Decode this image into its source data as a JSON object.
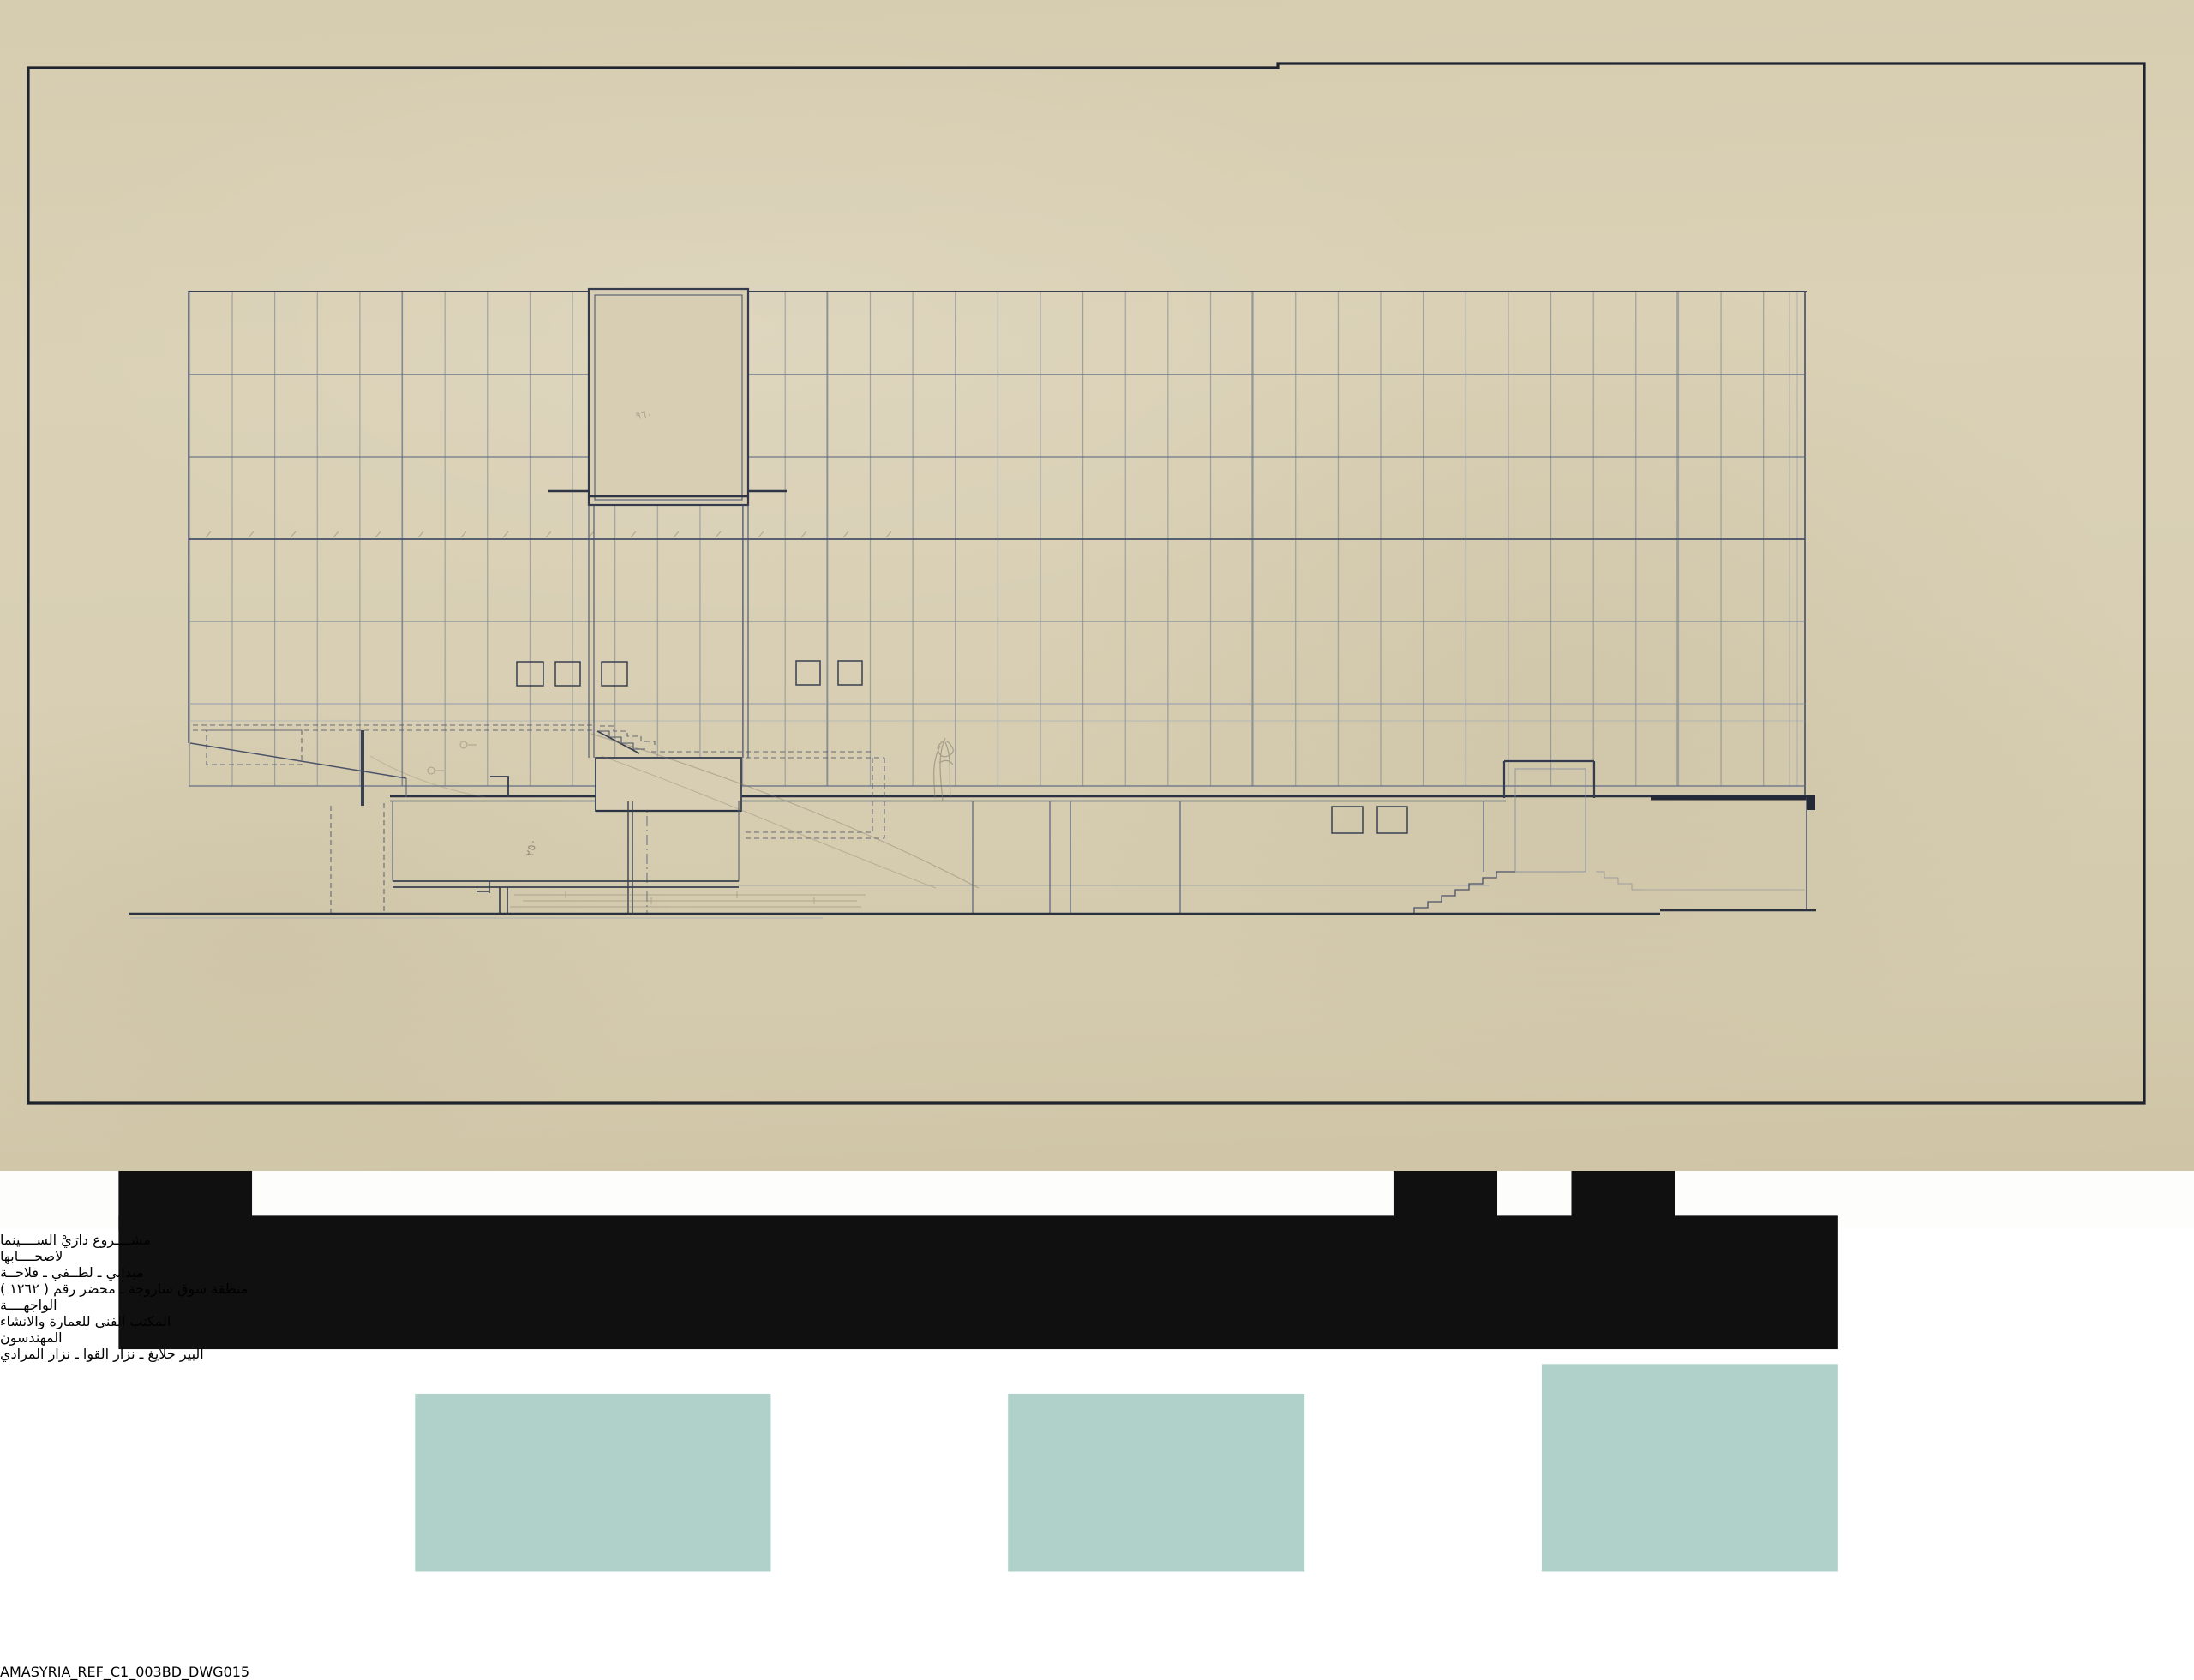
{
  "document": {
    "kind": "scanned architectural elevation drawing",
    "sheet": "aged beige tracing paper with dark ink border frame"
  },
  "title_block": {
    "lines": [
      {
        "text": "مشــــروع دارَيْ الســــينما"
      },
      {
        "text": "لاصحــــابها"
      },
      {
        "text": "ميداني ـ لطــفي ـ فلاحــة"
      },
      {
        "text": "منطقة سوق ساروجة ـ محضر رقم ( ١٢٦٢ )"
      },
      {
        "text": "الواجهــــة"
      },
      {
        "text": "المكتب الفني للعمارة والانشاء"
      },
      {
        "text": "المهندسون"
      },
      {
        "text": "البير جلايغ ـ نزار القوا ـ نزار المرادي"
      }
    ]
  },
  "annotations": {
    "pencil_250": "٢٥٠",
    "pencil_960": "٩٦٠"
  },
  "footer": {
    "bullet": "•",
    "reference": "AMASYRIA_REF_C1_003BD_DWG015",
    "logo_name": "amasyria-kufic-logo"
  },
  "colors": {
    "paper": "#d8cfb4",
    "frame_ink": "#1f232d",
    "ink_dark": "#2c3342",
    "ink_medium": "#4a5268",
    "ink_light": "#7e89a0",
    "ink_faint": "#93a0ba",
    "pencil": "#7d7668",
    "logo_teal": "#8fbdb2",
    "label_text": "#17181a",
    "background": "#ffffff"
  }
}
